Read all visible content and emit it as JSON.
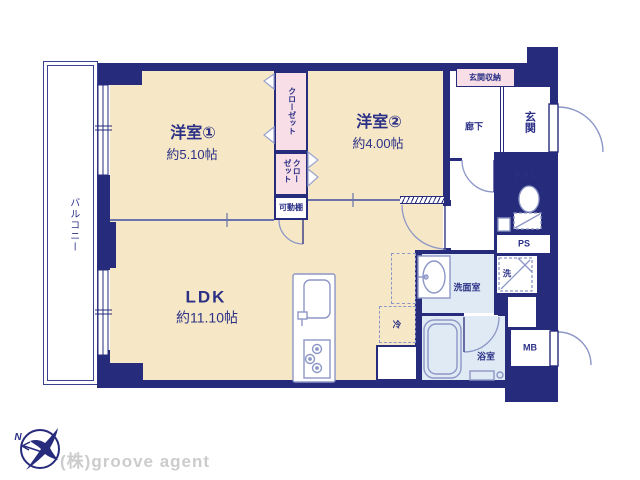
{
  "title": "2LDK apartment floor plan",
  "colors": {
    "wall_navy": "#272b7c",
    "room_beige": "#f6e7c6",
    "closet_pink": "#f8dee6",
    "wet_area_blue": "#dfeaf5",
    "fixture_line": "#8d97c7",
    "text_navy": "#2b3086",
    "logo_gray": "#cccccc"
  },
  "balcony": {
    "label": "バルコニー"
  },
  "rooms": {
    "room1": {
      "name": "洋室①",
      "size": "約5.10帖"
    },
    "room2": {
      "name": "洋室②",
      "size": "約4.00帖"
    },
    "ldk": {
      "name": "LDK",
      "size": "約11.10帖"
    },
    "closet_upper": {
      "label": "クローゼット"
    },
    "closet_lower": {
      "label": "クローゼット"
    },
    "movable_shelf": {
      "label": "可動棚"
    },
    "entrance_storage": {
      "label": "玄関収納"
    },
    "hallway": {
      "label": "廊下"
    },
    "entrance": {
      "label": "玄関"
    },
    "toilet": {
      "label": "トイレ"
    },
    "pipe_space": {
      "label": "PS"
    },
    "washer": {
      "label": "洗"
    },
    "washroom": {
      "label": "洗面室"
    },
    "fridge": {
      "label": "冷"
    },
    "bathroom": {
      "label": "浴室"
    },
    "meter_box": {
      "label": "MB"
    }
  },
  "compass": {
    "north_label": "N"
  },
  "footer": {
    "company": "(株)groove agent"
  }
}
